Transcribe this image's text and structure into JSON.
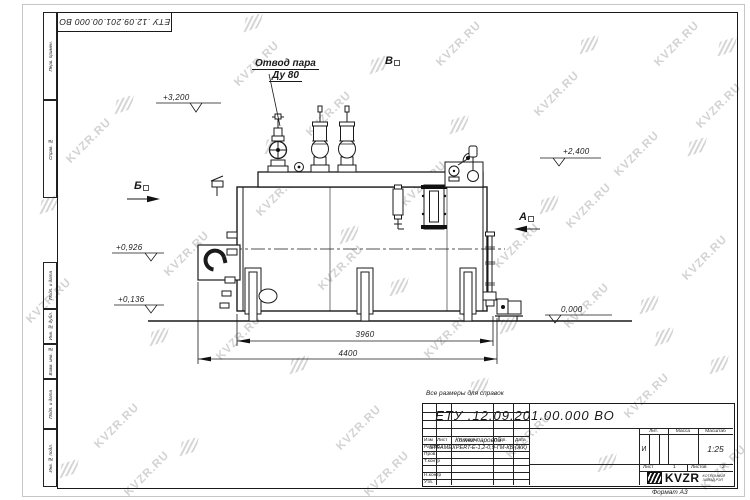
{
  "watermark": {
    "text": "KVZR.RU"
  },
  "corner_stamp": {
    "doc_number": "ЕТУ .12.09.201.00.000  ВО"
  },
  "margin_stamps": [
    "Перв. примен.",
    "Справ. №",
    "Подп. и дата",
    "Инв. № дубл.",
    "Взам. инв. №",
    "Подп. и дата",
    "Инв. № подл."
  ],
  "drawing": {
    "callout_line1": "Отвод пара",
    "callout_line2": "Ду 80",
    "views": {
      "a": "А",
      "b": "Б",
      "v": "В"
    },
    "elevations": {
      "e1": "+3,200",
      "e2": "+2,400",
      "e3": "+0,926",
      "e4": "+0,136",
      "e5": "0,000"
    },
    "dimensions": {
      "inner": "3960",
      "outer": "4400"
    }
  },
  "note": "Все размеры для справок",
  "title_block": {
    "doc_number": "ЕТУ .12.09.201.00.000  ВО",
    "product_name_line1": "Котел паровой",
    "product_name_line2": "STEAMEXPERT-Е-1,2-0,9-ГМ-КБ (ЖК)",
    "columns": [
      "Изм",
      "Лист",
      "N докум.",
      "Подп.",
      "Дата"
    ],
    "rows": [
      "Разраб.",
      "Пров.",
      "Т.контр",
      "",
      "Н.контр",
      "Утв."
    ],
    "lit_label": "Лит.",
    "mass_label": "Масса",
    "scale_label": "Масштаб",
    "lit_value": "И",
    "scale_value": "1:25",
    "sheet_label": "Лист",
    "sheet_value": "1",
    "sheets_label": "Листов",
    "sheets_value": "2",
    "logo_text": "KVZR",
    "company_line1": "КОТЕЛЬНЫЙ",
    "company_line2": "ЗАВОД РЭП",
    "format_note": "Формат А3"
  }
}
